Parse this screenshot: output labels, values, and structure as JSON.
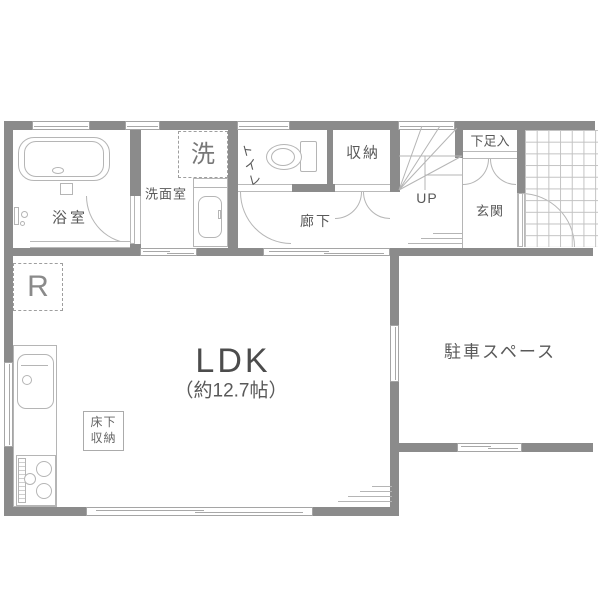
{
  "rooms": {
    "bathroom": {
      "label": "浴室"
    },
    "washroom": {
      "label": "洗面室"
    },
    "washing_machine": {
      "label": "洗"
    },
    "toilet": {
      "label": "トイレ"
    },
    "storage": {
      "label": "収納"
    },
    "hallway": {
      "label": "廊下"
    },
    "stairs": {
      "up_label": "UP"
    },
    "shoe_closet": {
      "label": "下足入"
    },
    "entrance": {
      "label": "玄関"
    },
    "ldk": {
      "label": "LDK",
      "area": "（約12.7帖）"
    },
    "underfloor_storage": {
      "line1": "床下",
      "line2": "収納"
    },
    "refrigerator": {
      "label": "R"
    },
    "parking": {
      "label": "駐車スペース"
    }
  },
  "colors": {
    "wall": "#8b8b8b",
    "line": "#b5b5b5",
    "text": "#595959",
    "grid": "#c2c2c2",
    "text_light": "#777777"
  }
}
